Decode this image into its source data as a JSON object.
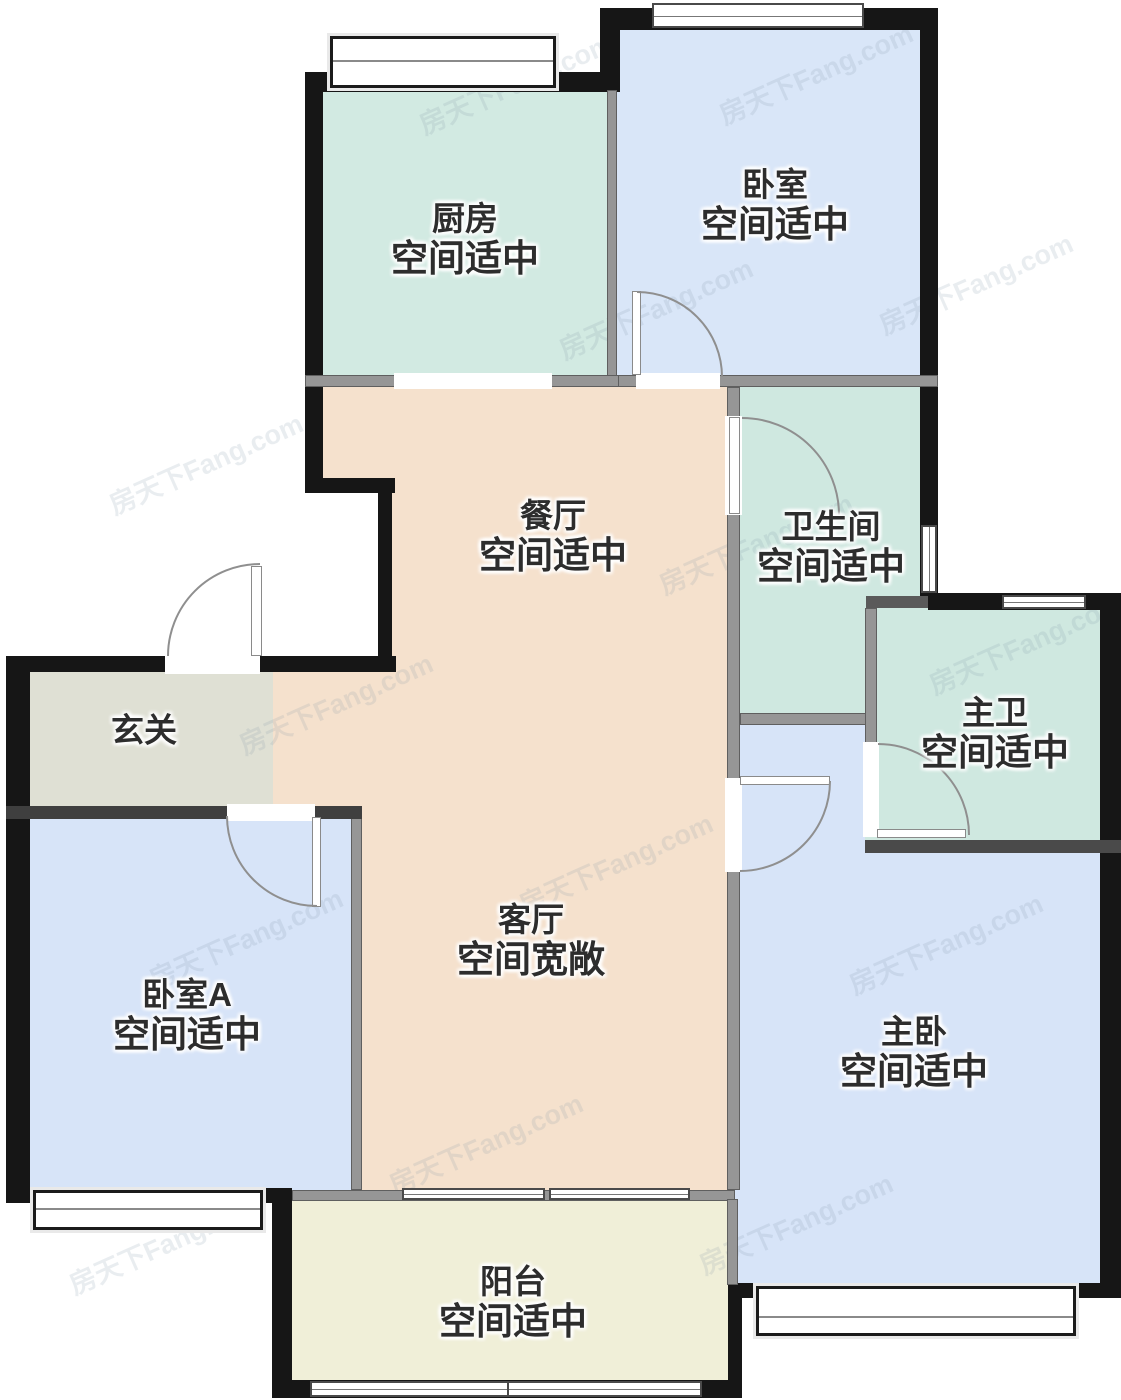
{
  "watermark": {
    "text": "房天下Fang.com"
  },
  "room_colors": {
    "kitchen": "#d2eae2",
    "bedroom": "#d9e6f8",
    "dining": "#f5e1cd",
    "living": "#f5e1cd",
    "foyer": "#dfe0d4",
    "bedroom_a": "#d7e4f8",
    "bathroom": "#cfe8e0",
    "master_bath": "#cfe8e0",
    "master_bedroom": "#d7e4f8",
    "balcony": "#f0efd8"
  },
  "wall_colors": {
    "exterior": "#161616",
    "interior": "#969696"
  },
  "rooms": {
    "kitchen": {
      "name": "厨房",
      "condition": "空间适中"
    },
    "bedroom": {
      "name": "卧室",
      "condition": "空间适中"
    },
    "dining": {
      "name": "餐厅",
      "condition": "空间适中"
    },
    "bathroom": {
      "name": "卫生间",
      "condition": "空间适中"
    },
    "master_bath": {
      "name": "主卫",
      "condition": "空间适中"
    },
    "foyer": {
      "name": "玄关",
      "condition": ""
    },
    "bedroom_a": {
      "name": "卧室A",
      "condition": "空间适中"
    },
    "living": {
      "name": "客厅",
      "condition": "空间宽敞"
    },
    "master_bedroom": {
      "name": "主卧",
      "condition": "空间适中"
    },
    "balcony": {
      "name": "阳台",
      "condition": "空间适中"
    }
  }
}
